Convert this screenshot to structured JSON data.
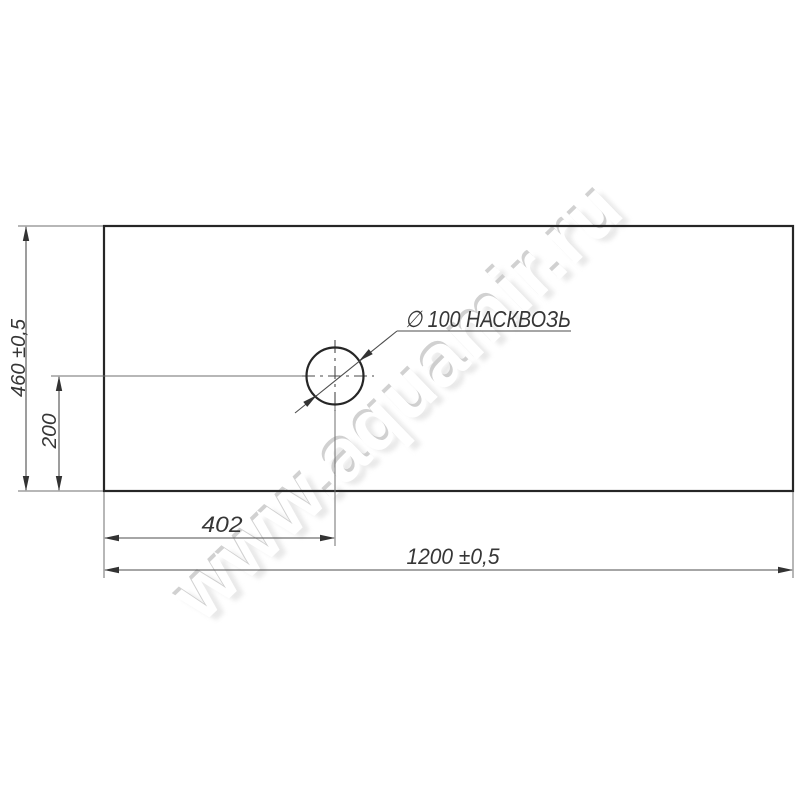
{
  "labels": {
    "hole_note": "∅ 100 НАСКВОЗЬ",
    "width": "1200 ±0,5",
    "height": "460 ±0,5",
    "hole_offset_x": "402",
    "hole_offset_y": "200"
  },
  "values": {
    "panel_width_mm": 1200,
    "panel_height_mm": 460,
    "hole_diameter_mm": 100,
    "hole_center_from_left_mm": 402,
    "hole_center_from_bottom_mm": 200,
    "tolerance": "±0,5"
  },
  "watermark": {
    "text": "www.aquamir.ru"
  },
  "colors": {
    "background": "#ffffff",
    "outline": "#262626",
    "dimension_lines": "#4d4d4d",
    "text": "#363636",
    "watermark": "#c9c9c9"
  }
}
